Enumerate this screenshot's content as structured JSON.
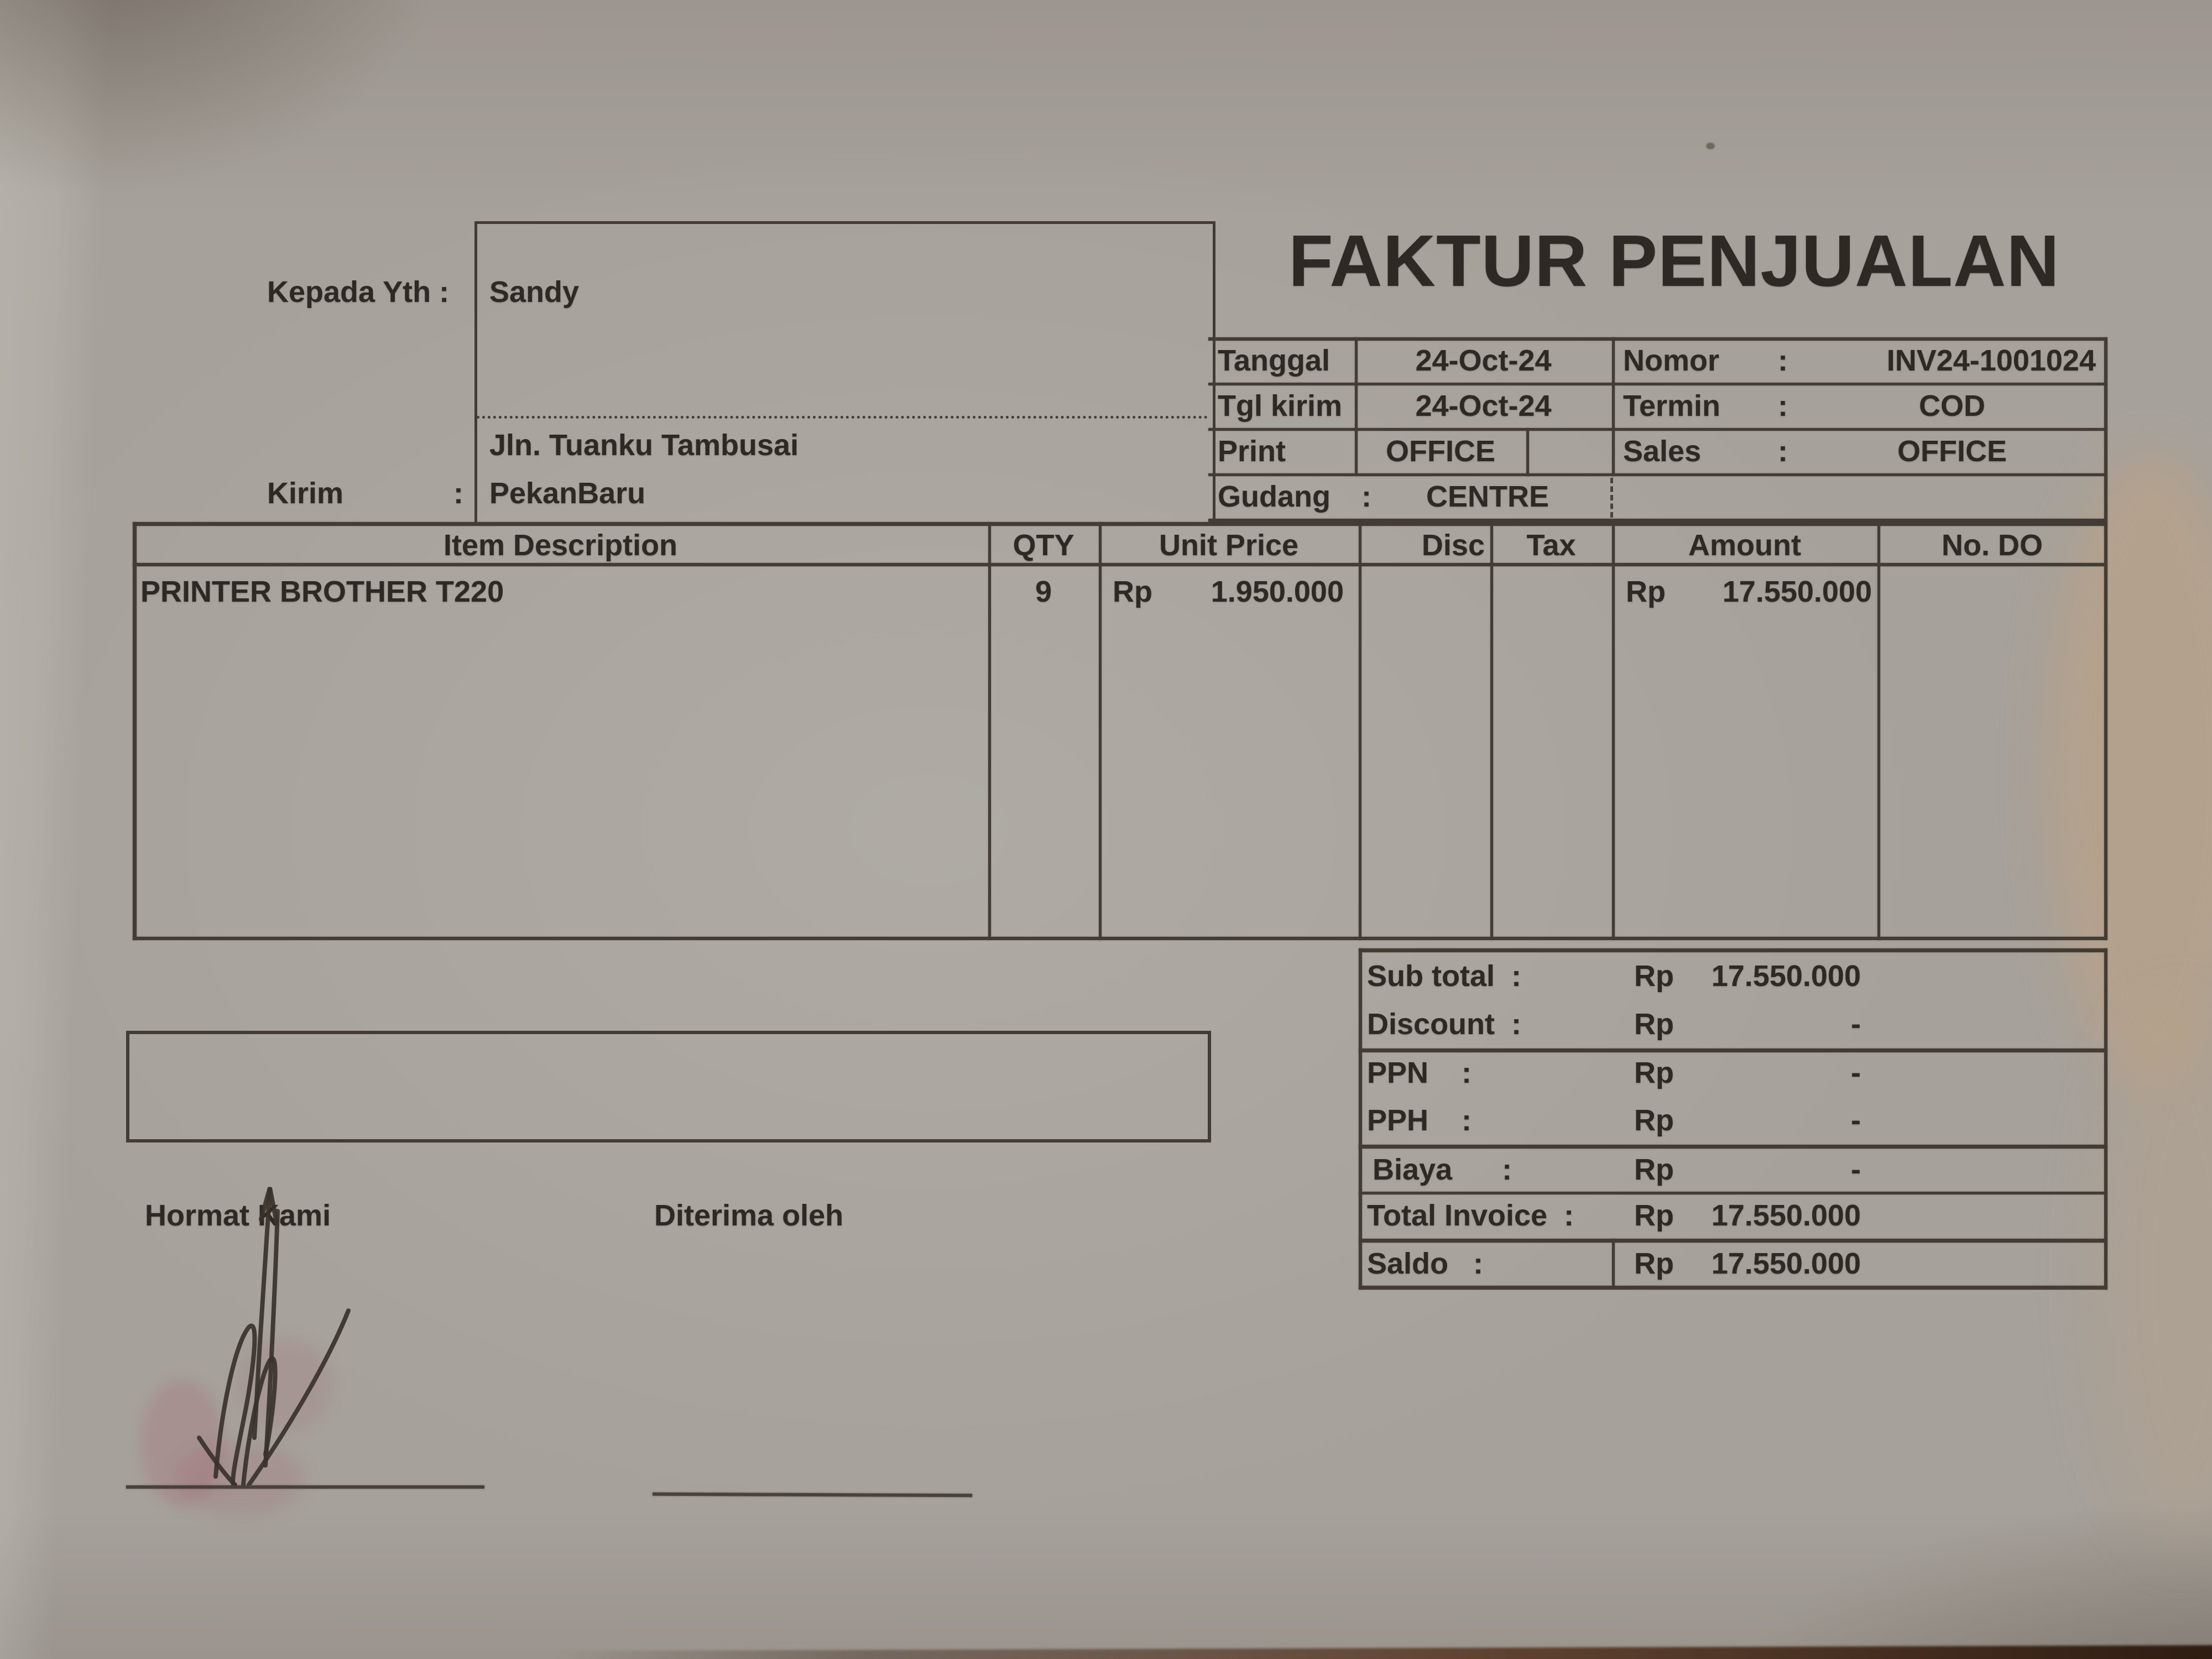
{
  "document": {
    "title": "FAKTUR PENJUALAN",
    "recipient": {
      "label": "Kepada Yth :",
      "name": "Sandy",
      "address_line1": "Jln. Tuanku Tambusai",
      "address_line2": "PekanBaru",
      "kirim_label": "Kirim",
      "kirim_colon": ":"
    },
    "info": {
      "tanggal_label": "Tanggal",
      "tanggal_value": "24-Oct-24",
      "nomor_label": "Nomor",
      "nomor_colon": ":",
      "nomor_value": "INV24-1001024",
      "tgl_kirim_label": "Tgl kirim",
      "tgl_kirim_value": "24-Oct-24",
      "termin_label": "Termin",
      "termin_colon": ":",
      "termin_value": "COD",
      "print_label": "Print",
      "print_value": "OFFICE",
      "sales_label": "Sales",
      "sales_colon": ":",
      "sales_value": "OFFICE",
      "gudang_label": "Gudang",
      "gudang_colon": ":",
      "gudang_value": "CENTRE"
    },
    "items_table": {
      "headers": {
        "description": "Item Description",
        "qty": "QTY",
        "unit_price": "Unit Price",
        "disc": "Disc",
        "tax": "Tax",
        "amount": "Amount",
        "no_do": "No. DO"
      },
      "rows": [
        {
          "description": "PRINTER BROTHER T220",
          "qty": "9",
          "unit_currency": "Rp",
          "unit_price": "1.950.000",
          "disc": "",
          "tax": "",
          "amount_currency": "Rp",
          "amount": "17.550.000",
          "no_do": ""
        }
      ]
    },
    "totals": {
      "sub_total": {
        "label": "Sub total  :",
        "currency": "Rp",
        "value": "17.550.000"
      },
      "discount": {
        "label": "Discount  :",
        "currency": "Rp",
        "value": "-"
      },
      "ppn": {
        "label": "PPN    :",
        "currency": "Rp",
        "value": "-"
      },
      "pph": {
        "label": "PPH    :",
        "currency": "Rp",
        "value": "-"
      },
      "biaya": {
        "label": "Biaya      :",
        "currency": "Rp",
        "value": "-"
      },
      "total_invoice": {
        "label": "Total Invoice  :",
        "currency": "Rp",
        "value": "17.550.000"
      },
      "saldo": {
        "label": "Saldo   :",
        "currency": "Rp",
        "value": "17.550.000"
      }
    },
    "signatures": {
      "left_label": "Hormat Kami",
      "right_label": "Diterima oleh"
    },
    "colors": {
      "paper": "#a6a19a",
      "ink": "#2e2925",
      "line": "#423c35",
      "table_edge": "#2e1a10",
      "signature_smudge": "#a83e5c"
    }
  }
}
